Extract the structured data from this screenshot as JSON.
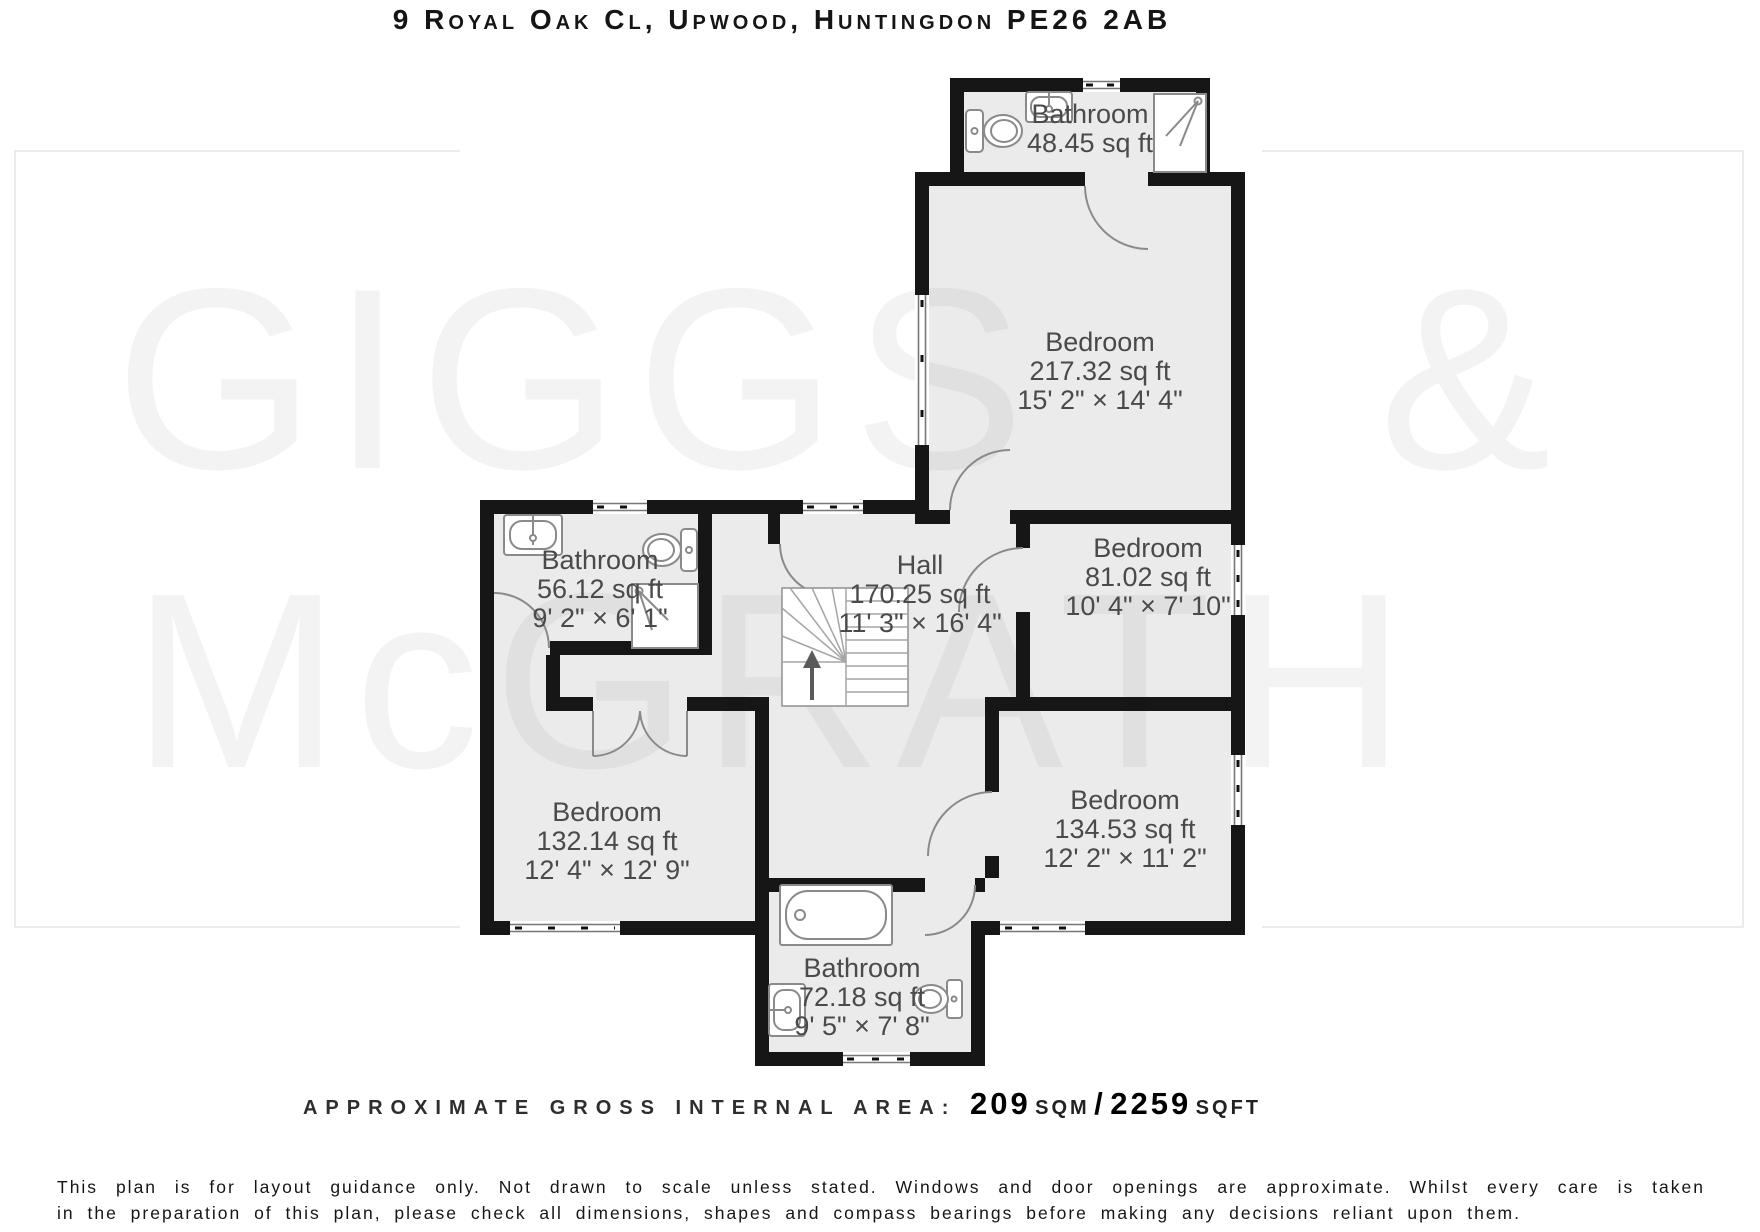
{
  "title": "9 Royal Oak Cl, Upwood, Huntingdon PE26 2AB",
  "watermark": {
    "giggs": "GIGGS",
    "ampersand": "&",
    "mcgrath": "McGRATH"
  },
  "rooms": [
    {
      "id": "bathroom-ensuite",
      "name": "Bathroom",
      "area": "48.45 sq ft",
      "dims": ""
    },
    {
      "id": "bedroom-master",
      "name": "Bedroom",
      "area": "217.32 sq ft",
      "dims": "15' 2\" × 14' 4\""
    },
    {
      "id": "bathroom-middle",
      "name": "Bathroom",
      "area": "56.12 sq ft",
      "dims": "9' 2\" × 6' 1\""
    },
    {
      "id": "hall",
      "name": "Hall",
      "area": "170.25 sq ft",
      "dims": "11' 3\" × 16' 4\""
    },
    {
      "id": "bedroom-right",
      "name": "Bedroom",
      "area": "81.02 sq ft",
      "dims": "10' 4\" × 7' 10\""
    },
    {
      "id": "bedroom-left",
      "name": "Bedroom",
      "area": "132.14 sq ft",
      "dims": "12' 4\" × 12' 9\""
    },
    {
      "id": "bedroom-bottom",
      "name": "Bedroom",
      "area": "134.53 sq ft",
      "dims": "12' 2\" × 11' 2\""
    },
    {
      "id": "bathroom-bottom",
      "name": "Bathroom",
      "area": "72.18 sq ft",
      "dims": "9' 5\" × 7' 8\""
    }
  ],
  "footer": {
    "label": "APPROXIMATE GROSS INTERNAL AREA: ",
    "sqm_value": "209",
    "sqm_unit": "SQM",
    "separator": "/",
    "sqft_value": "2259",
    "sqft_unit": "SQFT"
  },
  "disclaimer": {
    "line1": "This plan is for layout guidance only. Not drawn to scale unless stated. Windows and door openings are approximate. Whilst every care is taken",
    "line2": "in the preparation of this plan, please check all dimensions, shapes and compass bearings before making any decisions reliant upon them."
  },
  "colors": {
    "wall": "#161616",
    "room_fill": "rgba(0,0,0,0.08)",
    "fixture_stroke": "#8a8a8a",
    "watermark": "#f3f3f3",
    "label_text": "#4a4a4a"
  }
}
